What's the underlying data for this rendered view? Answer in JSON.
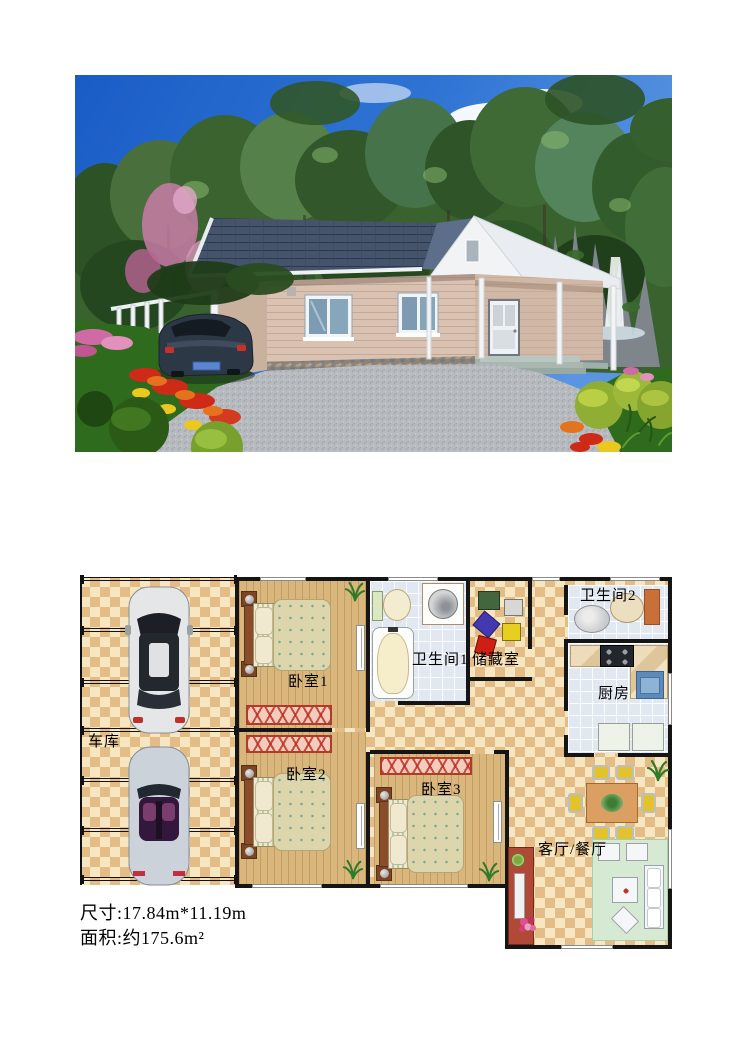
{
  "photo": {
    "subject": "single-story-house-exterior-rendering",
    "colors": {
      "sky": "#2a6cd0",
      "trees": "#3a6330",
      "roof": "#45536b",
      "wall_siding": "#d9c2b2",
      "porch_white": "#eef1f4",
      "driveway": "#b7bbbf",
      "grass": "#2f6b1d",
      "car": "#2c3845"
    }
  },
  "plan": {
    "rooms": [
      {
        "key": "garage",
        "label": "车库"
      },
      {
        "key": "bedroom1",
        "label": "卧室1"
      },
      {
        "key": "bedroom2",
        "label": "卧室2"
      },
      {
        "key": "bedroom3",
        "label": "卧室3"
      },
      {
        "key": "bathroom1",
        "label": "卫生间1"
      },
      {
        "key": "bathroom2",
        "label": "卫生间2"
      },
      {
        "key": "storage",
        "label": "储藏室"
      },
      {
        "key": "kitchen",
        "label": "厨房"
      },
      {
        "key": "living",
        "label": "客厅/餐厅"
      }
    ],
    "colors": {
      "checker_light": "#f6e7c2",
      "checker_dark": "#e3bd85",
      "wood_floor": "#d8b67c",
      "tile_floor": "#e2e8f1",
      "wall": "#151515",
      "rug_border": "#b13a28"
    }
  },
  "specs": {
    "dimensions": "尺寸:17.84m*11.19m",
    "area": "面积:约175.6m²"
  }
}
